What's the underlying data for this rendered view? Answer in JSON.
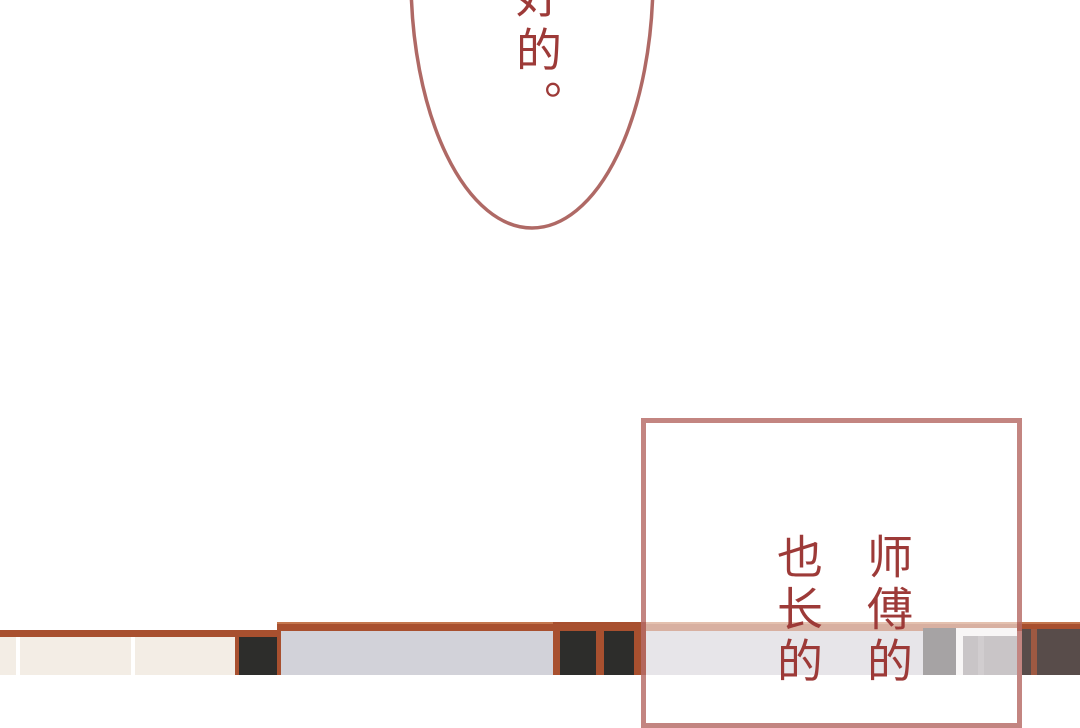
{
  "panel": {
    "speech_bubble": {
      "text": "好的。"
    },
    "caption_box": {
      "columns": [
        "师傅的",
        "也长的"
      ]
    }
  },
  "palette": {
    "text_maroon": "#9d3a38",
    "bubble_stroke": "#af6965",
    "box_border": "rgba(158,58,52,0.62)",
    "box_fill": "rgba(255,255,255,0.55)",
    "rust_brown": "#a8502f",
    "rust_highlight": "#c4774e",
    "cream_wall": "#f3ede5",
    "tile_line_white": "#ffffff",
    "panel_black": "#2d2d2b",
    "panel_gray": "#d2d2d9",
    "wall_gray_muted": "#cac5ce",
    "dark_block": "#3b3337",
    "off_white": "#f0ebeb",
    "light_block": "#877e83",
    "light_stripe": "#9a9196",
    "dark_wood": "#584c4a",
    "wood_stripe": "#9e5942"
  }
}
